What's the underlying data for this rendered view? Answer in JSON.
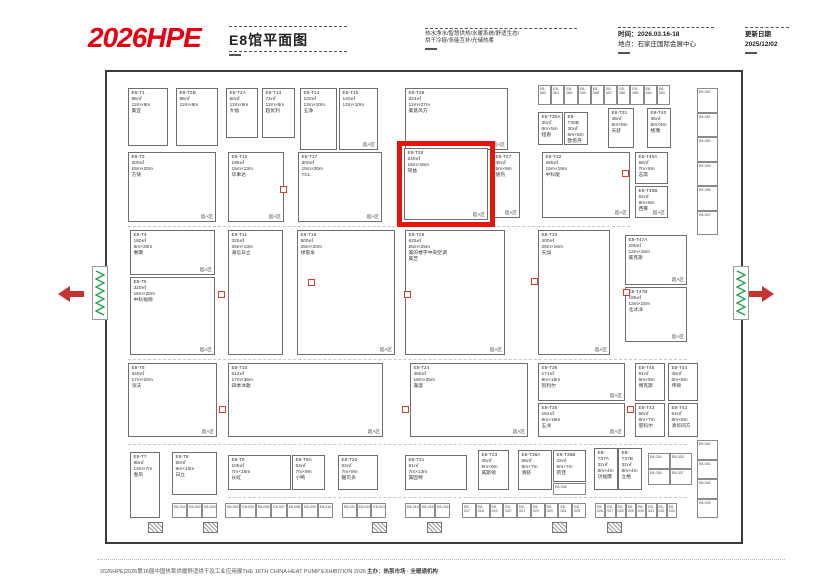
{
  "header": {
    "brand": "2026HPE",
    "hall_title": "E8馆平面图",
    "services_line1": "热水净水/智慧供热/水暖系统/舒适生态/",
    "services_line2": "烘干冷链/多能互补/光储热柔",
    "time_label": "时间：2026.03.16-18",
    "venue_label": "地点：石家庄国际会展中心",
    "update_label": "更新日期",
    "update_date": "2025/12/02"
  },
  "zone_label": "超A区",
  "colors": {
    "brand_red": "#e60012",
    "highlight_red": "#e8140c",
    "marker_red": "#e0392e",
    "stairs_green": "#1fa14a"
  },
  "booths": [
    {
      "id": "E8-T1",
      "area": "96㎡",
      "size": "12m×8m",
      "name": "美宜",
      "x": 128,
      "y": 88,
      "w": 40,
      "h": 58,
      "zone": false,
      "hl": false
    },
    {
      "id": "E8-T2B",
      "area": "96㎡",
      "size": "12m×8m",
      "name": "",
      "x": 176,
      "y": 88,
      "w": 42,
      "h": 58,
      "zone": false,
      "hl": false
    },
    {
      "id": "E8-T2A",
      "area": "60㎡",
      "size": "12m×5m",
      "name": "大福",
      "x": 226,
      "y": 88,
      "w": 32,
      "h": 50,
      "zone": false,
      "hl": false
    },
    {
      "id": "E8-T13",
      "area": "72㎡",
      "size": "12m×6m",
      "name": "超优利",
      "x": 262,
      "y": 88,
      "w": 33,
      "h": 50,
      "zone": false,
      "hl": false
    },
    {
      "id": "E8-T14",
      "area": "120㎡",
      "size": "12m×10m",
      "name": "五净",
      "x": 300,
      "y": 88,
      "w": 37,
      "h": 62,
      "zone": false,
      "hl": false
    },
    {
      "id": "E8-T15",
      "area": "120㎡",
      "size": "12m×10m",
      "name": "",
      "x": 339,
      "y": 88,
      "w": 39,
      "h": 62,
      "zone": true,
      "hl": false
    },
    {
      "id": "E8-T29",
      "area": "324㎡",
      "size": "12m×27m",
      "name": "美意风方",
      "x": 405,
      "y": 88,
      "w": 103,
      "h": 62,
      "zone": true,
      "hl": false
    },
    {
      "id": "E8-T30A",
      "area": "30㎡",
      "size": "6m×5m",
      "name": "纽恩",
      "x": 538,
      "y": 112,
      "w": 25,
      "h": 33,
      "zone": false,
      "hl": false
    },
    {
      "id": "E8-T30B",
      "area": "30㎡",
      "size": "6m×5m",
      "name": "欧思丹",
      "x": 564,
      "y": 112,
      "w": 24,
      "h": 33,
      "zone": false,
      "hl": false
    },
    {
      "id": "E8-T31",
      "area": "48㎡",
      "size": "6m×8m",
      "name": "天舒",
      "x": 608,
      "y": 108,
      "w": 26,
      "h": 40,
      "zone": false,
      "hl": false
    },
    {
      "id": "E8-T40",
      "area": "36㎡",
      "size": "6m×6m",
      "name": "格瑞",
      "x": 647,
      "y": 108,
      "w": 24,
      "h": 40,
      "zone": false,
      "hl": false
    },
    {
      "id": "E8-T3",
      "area": "300㎡",
      "size": "15m×20m",
      "name": "方快",
      "x": 128,
      "y": 152,
      "w": 88,
      "h": 70,
      "zone": true,
      "hl": false
    },
    {
      "id": "E8-T12",
      "area": "195㎡",
      "size": "15m×13m",
      "name": "华事达",
      "x": 228,
      "y": 152,
      "w": 56,
      "h": 70,
      "zone": true,
      "hl": false
    },
    {
      "id": "E8-T17",
      "area": "300㎡",
      "size": "15m×20m",
      "name": "TCL",
      "x": 298,
      "y": 152,
      "w": 84,
      "h": 70,
      "zone": true,
      "hl": false
    },
    {
      "id": "E8-T28",
      "area": "240㎡",
      "size": "15m×16m",
      "name": "同益",
      "x": 404,
      "y": 148,
      "w": 84,
      "h": 72,
      "zone": true,
      "hl": true
    },
    {
      "id": "E8-T27",
      "area": "45㎡",
      "size": "5m×9m",
      "name": "德热",
      "x": 492,
      "y": 152,
      "w": 28,
      "h": 66,
      "zone": true,
      "hl": false
    },
    {
      "id": "E8-T32",
      "area": "285㎡",
      "size": "15m×19m",
      "name": "中科能",
      "x": 542,
      "y": 152,
      "w": 88,
      "h": 66,
      "zone": true,
      "hl": false
    },
    {
      "id": "E8-T40A",
      "area": "56㎡",
      "size": "7m×8m",
      "name": "志高",
      "x": 635,
      "y": 152,
      "w": 33,
      "h": 32,
      "zone": false,
      "hl": false
    },
    {
      "id": "E8-T40B",
      "area": "64㎡",
      "size": "8m×8m",
      "name": "西莱",
      "x": 635,
      "y": 186,
      "w": 33,
      "h": 32,
      "zone": true,
      "hl": false
    },
    {
      "id": "E8-T4",
      "area": "180㎡",
      "size": "9m×20m",
      "name": "惠康",
      "x": 130,
      "y": 230,
      "w": 85,
      "h": 45,
      "zone": true,
      "hl": false
    },
    {
      "id": "E8-T5",
      "area": "320㎡",
      "size": "16m×20m",
      "name": "中科福德",
      "x": 130,
      "y": 277,
      "w": 85,
      "h": 78,
      "zone": true,
      "hl": false
    },
    {
      "id": "E8-T11",
      "area": "325㎡",
      "size": "25m×13m",
      "name": "海信日立",
      "x": 228,
      "y": 230,
      "w": 55,
      "h": 125,
      "zone": false,
      "hl": false
    },
    {
      "id": "E8-T16",
      "area": "500㎡",
      "size": "25m×20m",
      "name": "绿思泉",
      "x": 297,
      "y": 230,
      "w": 98,
      "h": 125,
      "zone": true,
      "hl": false
    },
    {
      "id": "E8-T26",
      "area": "625㎡",
      "size": "25m×25m",
      "name": "美的楼宇中央空调",
      "name2": "美芝",
      "x": 405,
      "y": 230,
      "w": 100,
      "h": 125,
      "zone": true,
      "hl": false
    },
    {
      "id": "E8-T33",
      "area": "400㎡",
      "size": "25m×16m",
      "name": "天加",
      "x": 538,
      "y": 230,
      "w": 72,
      "h": 125,
      "zone": true,
      "hl": false
    },
    {
      "id": "E8-T47A",
      "area": "180㎡",
      "size": "12m×15m",
      "name": "美克斯",
      "x": 625,
      "y": 235,
      "w": 62,
      "h": 50,
      "zone": true,
      "hl": false
    },
    {
      "id": "E8-T47B",
      "area": "195㎡",
      "size": "13m×15m",
      "name": "北冰洋",
      "x": 625,
      "y": 287,
      "w": 62,
      "h": 55,
      "zone": true,
      "hl": false
    },
    {
      "id": "E8-T6",
      "area": "340㎡",
      "size": "17m×20m",
      "name": "派沃",
      "x": 128,
      "y": 363,
      "w": 89,
      "h": 74,
      "zone": true,
      "hl": false
    },
    {
      "id": "E8-T10",
      "area": "612㎡",
      "size": "17m×36m",
      "name": "四季沐歌",
      "x": 228,
      "y": 363,
      "w": 155,
      "h": 74,
      "zone": true,
      "hl": false
    },
    {
      "id": "E8-T24",
      "area": "450㎡",
      "size": "18m×25m",
      "name": "嘉度",
      "x": 410,
      "y": 363,
      "w": 118,
      "h": 74,
      "zone": true,
      "hl": false
    },
    {
      "id": "E8-T36",
      "area": "171㎡",
      "size": "9m×19m",
      "name": "凯利尔",
      "x": 538,
      "y": 363,
      "w": 87,
      "h": 38,
      "zone": true,
      "hl": false
    },
    {
      "id": "E8-T35",
      "area": "152㎡",
      "size": "8m×19m",
      "name": "五洲",
      "x": 538,
      "y": 403,
      "w": 87,
      "h": 34,
      "zone": true,
      "hl": false
    },
    {
      "id": "E8-T45",
      "area": "81㎡",
      "size": "9m×9m",
      "name": "博克斯",
      "x": 635,
      "y": 363,
      "w": 30,
      "h": 38,
      "zone": false,
      "hl": false
    },
    {
      "id": "E8-T44",
      "area": "48㎡",
      "size": "6m×8m",
      "name": "伟顿",
      "x": 668,
      "y": 363,
      "w": 30,
      "h": 38,
      "zone": false,
      "hl": false
    },
    {
      "id": "E8-T43",
      "area": "56㎡",
      "size": "8m×7m",
      "name": "思科尔",
      "x": 635,
      "y": 403,
      "w": 30,
      "h": 34,
      "zone": false,
      "hl": false
    },
    {
      "id": "E8-T42",
      "area": "64㎡",
      "size": "8m×8m",
      "name": "清华同方",
      "x": 668,
      "y": 403,
      "w": 30,
      "h": 34,
      "zone": false,
      "hl": false
    },
    {
      "id": "E8-T7",
      "area": "98㎡",
      "size": "14m×7m",
      "name": "春风",
      "x": 130,
      "y": 452,
      "w": 30,
      "h": 66,
      "zone": false,
      "hl": false
    },
    {
      "id": "E8-T8",
      "area": "90㎡",
      "size": "9m×10m",
      "name": "日立",
      "x": 172,
      "y": 452,
      "w": 45,
      "h": 43,
      "zone": false,
      "hl": false
    },
    {
      "id": "E8-T9",
      "area": "105㎡",
      "size": "7m×15m",
      "name": "长虹",
      "x": 228,
      "y": 455,
      "w": 63,
      "h": 35,
      "zone": false,
      "hl": false
    },
    {
      "id": "E8-T9A",
      "area": "63㎡",
      "size": "7m×9m",
      "name": "小鸭",
      "x": 292,
      "y": 455,
      "w": 33,
      "h": 35,
      "zone": false,
      "hl": false
    },
    {
      "id": "E8-T20",
      "area": "63㎡",
      "size": "7m×9m",
      "name": "暖贝多",
      "x": 338,
      "y": 455,
      "w": 40,
      "h": 35,
      "zone": false,
      "hl": false
    },
    {
      "id": "E8-T21",
      "area": "91㎡",
      "size": "7m×13m",
      "name": "美固特",
      "x": 405,
      "y": 455,
      "w": 62,
      "h": 35,
      "zone": false,
      "hl": false
    },
    {
      "id": "E8-T23",
      "area": "45㎡",
      "size": "5m×9m",
      "name": "威斯顿",
      "x": 478,
      "y": 450,
      "w": 31,
      "h": 40,
      "zone": false,
      "hl": false
    },
    {
      "id": "E8-T36A",
      "area": "56㎡",
      "size": "8m×7m",
      "name": "清舒",
      "x": 518,
      "y": 450,
      "w": 34,
      "h": 40,
      "zone": false,
      "hl": false
    },
    {
      "id": "E8-T36B",
      "area": "42㎡",
      "size": "6m×7m",
      "name": "航佳",
      "x": 553,
      "y": 450,
      "w": 33,
      "h": 32,
      "zone": false,
      "hl": false
    },
    {
      "id": "E8-T37A",
      "area": "32㎡",
      "size": "8m×4m",
      "name": "功福康",
      "x": 594,
      "y": 448,
      "w": 24,
      "h": 42,
      "zone": false,
      "hl": false
    },
    {
      "id": "E8-T37B",
      "area": "32㎡",
      "size": "8m×4m",
      "name": "立格",
      "x": 618,
      "y": 448,
      "w": 24,
      "h": 42,
      "zone": false,
      "hl": false
    }
  ],
  "cell_groups": [
    {
      "name": "top-strip",
      "x": 538,
      "y": 85,
      "w": 132,
      "h": 20,
      "cols": 10,
      "rows": 1,
      "ids": [
        "E8-062",
        "E8-061",
        "E8-060",
        "E8-059",
        "E8-058",
        "E8-057",
        "E8-056",
        "E8-055",
        "E8-054",
        "E8-053"
      ]
    },
    {
      "name": "right-strip-upper",
      "x": 697,
      "y": 88,
      "w": 21,
      "h": 147,
      "cols": 1,
      "rows": 6,
      "ids": [
        "E8-052",
        "E8-051",
        "E8-050",
        "E8-049",
        "E8-048",
        "E8-047"
      ]
    },
    {
      "name": "right-strip-lower",
      "x": 697,
      "y": 440,
      "w": 21,
      "h": 78,
      "cols": 1,
      "rows": 4,
      "ids": [
        "E8-042",
        "E8-041",
        "E8-040",
        "E8-039"
      ]
    },
    {
      "name": "bottom-strip-a",
      "x": 172,
      "y": 503,
      "w": 45,
      "h": 15,
      "cols": 3,
      "rows": 1,
      "ids": [
        "E8-001",
        "E8-002",
        "E8-003"
      ]
    },
    {
      "name": "bottom-strip-b",
      "x": 225,
      "y": 503,
      "w": 108,
      "h": 15,
      "cols": 7,
      "rows": 1,
      "ids": [
        "E8-004",
        "E8-005",
        "E8-006",
        "E8-007",
        "E8-008",
        "E8-009",
        "E8-010"
      ]
    },
    {
      "name": "bottom-strip-c",
      "x": 342,
      "y": 503,
      "w": 44,
      "h": 15,
      "cols": 3,
      "rows": 1,
      "ids": [
        "E8-011",
        "E8-012",
        "E8-013"
      ]
    },
    {
      "name": "bottom-strip-d",
      "x": 405,
      "y": 503,
      "w": 45,
      "h": 15,
      "cols": 3,
      "rows": 1,
      "ids": [
        "E8-014",
        "E8-015",
        "E8-016"
      ]
    },
    {
      "name": "bottom-strip-e",
      "x": 462,
      "y": 503,
      "w": 124,
      "h": 15,
      "cols": 9,
      "rows": 1,
      "ids": [
        "E8-017",
        "E8-018",
        "E8-019",
        "E8-020",
        "E8-021",
        "E8-022",
        "E8-023",
        "E8-024",
        "E8-025"
      ]
    },
    {
      "name": "bottom-strip-f",
      "x": 595,
      "y": 503,
      "w": 82,
      "h": 15,
      "cols": 8,
      "rows": 1,
      "ids": [
        "E8-026",
        "E8-027",
        "E8-028",
        "E8-029",
        "E8-030",
        "E8-031",
        "E8-032",
        "E8-033"
      ]
    },
    {
      "name": "block-2x2",
      "x": 648,
      "y": 453,
      "w": 44,
      "h": 32,
      "cols": 2,
      "rows": 2,
      "ids": [
        "E8-034",
        "E8-035",
        "E8-036",
        "E8-037"
      ]
    },
    {
      "name": "sub-cell",
      "x": 553,
      "y": 483,
      "w": 33,
      "h": 12,
      "cols": 1,
      "rows": 1,
      "ids": [
        "E8-038"
      ]
    }
  ],
  "markers": [
    [
      280,
      186
    ],
    [
      408,
      176
    ],
    [
      622,
      170
    ],
    [
      218,
      291
    ],
    [
      308,
      279
    ],
    [
      404,
      291
    ],
    [
      531,
      278
    ],
    [
      623,
      289
    ],
    [
      219,
      406
    ],
    [
      402,
      406
    ],
    [
      627,
      406
    ]
  ],
  "doors": [
    [
      148,
      522
    ],
    [
      203,
      522
    ],
    [
      372,
      522
    ],
    [
      427,
      522
    ],
    [
      552,
      522
    ],
    [
      607,
      522
    ]
  ],
  "footer": {
    "left": "2026HPE|2026第16届中国热泵供暖舒适烘干及工业应用展THE 16TH CHINA HEAT PUMP EXHIBITION 2026",
    "right": "主办：热泵市场 · 全暖通机构"
  }
}
